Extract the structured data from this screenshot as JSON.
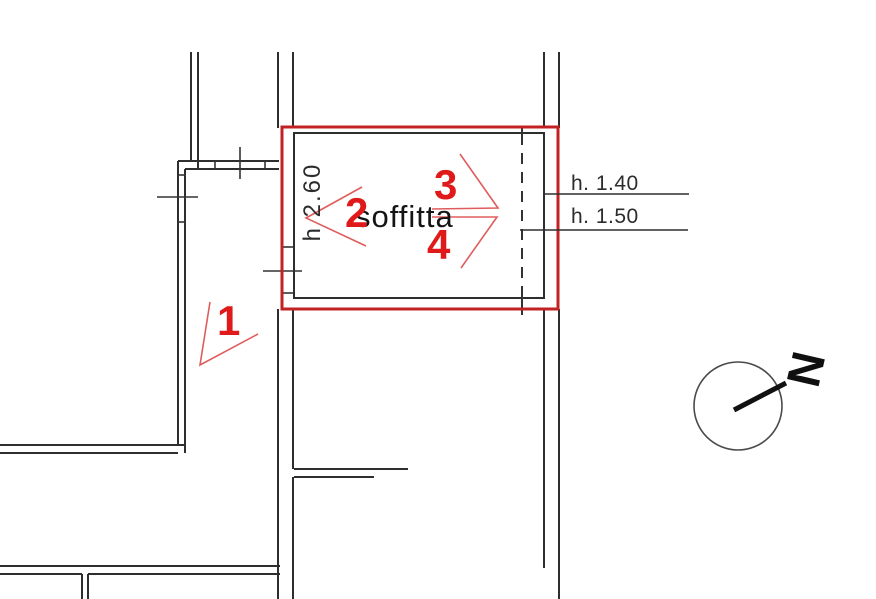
{
  "plan": {
    "room_label": "soffitta",
    "room_height_label": "h 2.60",
    "height_annotations": [
      {
        "label": "h. 1.40"
      },
      {
        "label": "h. 1.50"
      }
    ],
    "photo_markers": [
      {
        "label": "1"
      },
      {
        "label": "2"
      },
      {
        "label": "3"
      },
      {
        "label": "4"
      }
    ],
    "north_label": "N"
  },
  "colors": {
    "wall": "#2e2e2e",
    "highlight_red": "#c22222",
    "marker_red": "#e01a1a",
    "cone_red": "#e05d5d"
  }
}
